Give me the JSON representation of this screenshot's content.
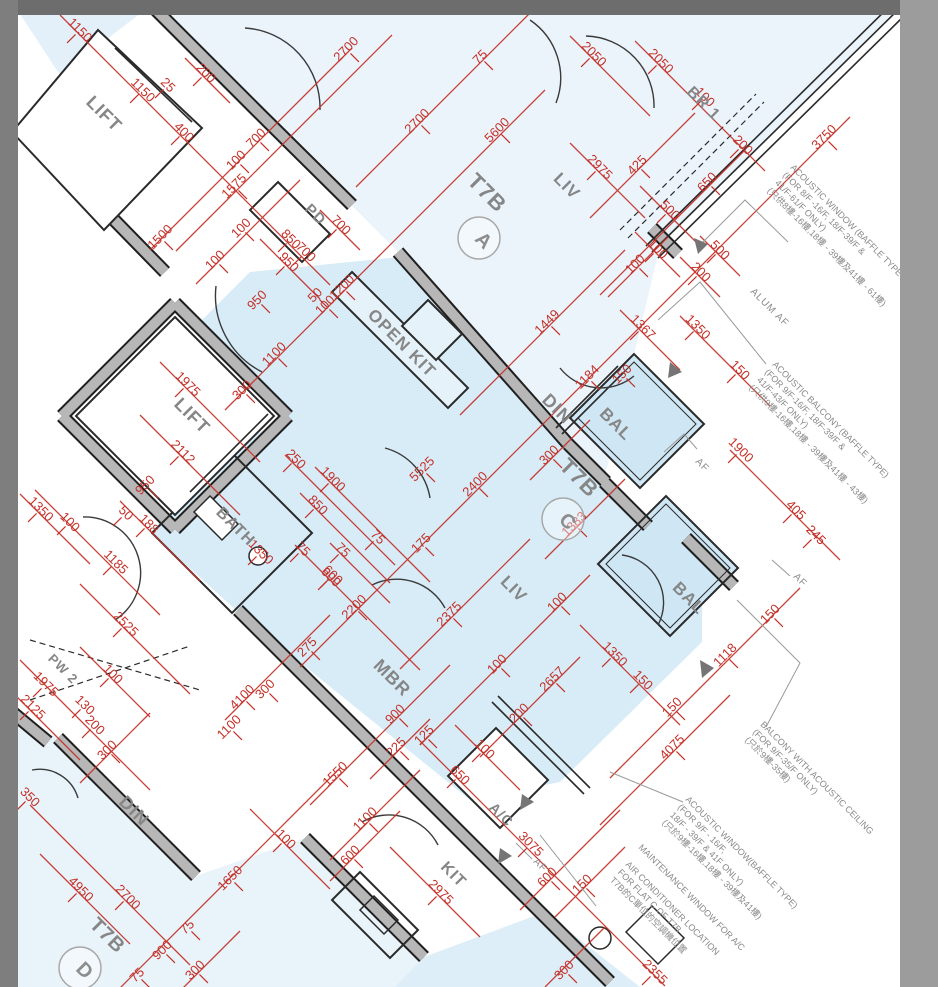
{
  "drawing": {
    "block_name": "T7B",
    "flats_visible": [
      "A",
      "C",
      "D"
    ],
    "colors": {
      "dimension_red": "#c43028",
      "wall_gray": "#b7b7b7",
      "wall_edge": "#1f1f1f",
      "floor_blue": "#d7ecf7",
      "floor_pale": "#ebf4fb",
      "label_gray": "#868686",
      "frame_top": "#6d6d6d",
      "frame_left": "#7e7e7e",
      "frame_right": "#9c9c9c"
    }
  },
  "room_labels": [
    {
      "t": "LIFT",
      "x": 100,
      "y": 118,
      "s": 18
    },
    {
      "t": "PD",
      "x": 312,
      "y": 218,
      "s": 15
    },
    {
      "t": "T7B",
      "x": 482,
      "y": 198,
      "s": 22
    },
    {
      "t": "LIV",
      "x": 563,
      "y": 190,
      "s": 17
    },
    {
      "t": "BR 1",
      "x": 700,
      "y": 107,
      "s": 16
    },
    {
      "t": "OPEN KIT",
      "x": 398,
      "y": 347,
      "s": 17
    },
    {
      "t": "DIN",
      "x": 553,
      "y": 413,
      "s": 18
    },
    {
      "t": "BAL",
      "x": 612,
      "y": 428,
      "s": 17
    },
    {
      "t": "LIFT",
      "x": 188,
      "y": 420,
      "s": 18
    },
    {
      "t": "BATH",
      "x": 232,
      "y": 530,
      "s": 16
    },
    {
      "t": "T7B",
      "x": 574,
      "y": 483,
      "s": 22
    },
    {
      "t": "LIV",
      "x": 510,
      "y": 593,
      "s": 17
    },
    {
      "t": "BAL",
      "x": 685,
      "y": 602,
      "s": 17
    },
    {
      "t": "MBR",
      "x": 388,
      "y": 682,
      "s": 18
    },
    {
      "t": "PW 2",
      "x": 60,
      "y": 672,
      "s": 13
    },
    {
      "t": "DIN",
      "x": 130,
      "y": 815,
      "s": 18
    },
    {
      "t": "A/C",
      "x": 498,
      "y": 818,
      "s": 14
    },
    {
      "t": "KIT",
      "x": 450,
      "y": 878,
      "s": 16
    },
    {
      "t": "T7B",
      "x": 103,
      "y": 940,
      "s": 20
    }
  ],
  "flat_badges": [
    {
      "t": "A",
      "x": 479,
      "y": 238
    },
    {
      "t": "C",
      "x": 563,
      "y": 519
    },
    {
      "t": "D",
      "x": 80,
      "y": 968
    }
  ],
  "annotations": [
    {
      "t": "ALUM AF",
      "x": 750,
      "y": 292
    },
    {
      "t": "AF",
      "x": 695,
      "y": 462
    },
    {
      "t": "AF",
      "x": 793,
      "y": 577
    },
    {
      "t": "AF",
      "x": 533,
      "y": 862
    }
  ],
  "notes": [
    {
      "x": 790,
      "y": 168,
      "lines": [
        "ACOUSTIC WINDOW (BAFFLE TYPE",
        "(FOR 8/F -16/F, 18/F-39/F &",
        "41/F-61/F ONLY)",
        "(只供8樓-16樓,18樓 - 39樓及41樓 - 61樓)"
      ]
    },
    {
      "x": 772,
      "y": 365,
      "lines": [
        "ACOUSTIC BALCONY (BAFFLE TYPE)",
        "(FOR 9/F-16/F, 18/F-39/F &",
        "41/F-43/F ONLY)",
        "(只供9樓-16樓,18樓 - 39樓及41樓 - 43樓)"
      ]
    },
    {
      "x": 760,
      "y": 725,
      "lines": [
        "BALCONY WITH ACOUSTIC CEILING",
        "(FOR 9/F-35/F ONLY)",
        "(只於9樓-35樓)"
      ]
    },
    {
      "x": 685,
      "y": 800,
      "lines": [
        "ACOUSTIC WINDOW(BAFFLE TYPE)",
        "(FOR 9/F - 16/F,",
        "18/F - 39/F & 41F ONLY)",
        "(只於9樓-16樓,18樓 - 39樓及41樓)"
      ]
    },
    {
      "x": 638,
      "y": 848,
      "lines": [
        "MAINTENANCE WINDOW FOR A/C"
      ]
    },
    {
      "x": 625,
      "y": 865,
      "lines": [
        "AIR CONDITIONER LOCATION",
        "FOR FLAT C OF T7B",
        "T7B的C單位的空調機位置"
      ]
    }
  ],
  "dimensions": [
    {
      "t": "1150",
      "x": 77,
      "y": 33,
      "r": 45
    },
    {
      "t": "1150",
      "x": 140,
      "y": 93,
      "r": 45
    },
    {
      "t": "25",
      "x": 165,
      "y": 88,
      "r": 45
    },
    {
      "t": "200",
      "x": 203,
      "y": 76,
      "r": 45
    },
    {
      "t": "400",
      "x": 181,
      "y": 135,
      "r": 45
    },
    {
      "t": "100",
      "x": 239,
      "y": 163,
      "r": -45
    },
    {
      "t": "700",
      "x": 259,
      "y": 141,
      "r": -45
    },
    {
      "t": "1575",
      "x": 237,
      "y": 189,
      "r": -45
    },
    {
      "t": "100",
      "x": 244,
      "y": 231,
      "r": -45
    },
    {
      "t": "1500",
      "x": 163,
      "y": 240,
      "r": -45
    },
    {
      "t": "2700",
      "x": 349,
      "y": 52,
      "r": -45
    },
    {
      "t": "2700",
      "x": 420,
      "y": 124,
      "r": -45
    },
    {
      "t": "75",
      "x": 483,
      "y": 60,
      "r": -45
    },
    {
      "t": "5600",
      "x": 500,
      "y": 133,
      "r": -45
    },
    {
      "t": "2050",
      "x": 591,
      "y": 57,
      "r": 45
    },
    {
      "t": "2050",
      "x": 658,
      "y": 64,
      "r": 45
    },
    {
      "t": "100",
      "x": 702,
      "y": 100,
      "r": 45
    },
    {
      "t": "200",
      "x": 740,
      "y": 148,
      "r": 45
    },
    {
      "t": "3750",
      "x": 827,
      "y": 140,
      "r": -45
    },
    {
      "t": "425",
      "x": 640,
      "y": 168,
      "r": -45
    },
    {
      "t": "650",
      "x": 710,
      "y": 185,
      "r": -45
    },
    {
      "t": "2975",
      "x": 597,
      "y": 170,
      "r": 45
    },
    {
      "t": "500",
      "x": 667,
      "y": 213,
      "r": 45
    },
    {
      "t": "100",
      "x": 655,
      "y": 252,
      "r": 45
    },
    {
      "t": "100",
      "x": 638,
      "y": 267,
      "r": -45
    },
    {
      "t": "500",
      "x": 717,
      "y": 253,
      "r": 45
    },
    {
      "t": "200",
      "x": 698,
      "y": 275,
      "r": 45
    },
    {
      "t": "850",
      "x": 288,
      "y": 242,
      "r": 45
    },
    {
      "t": "950",
      "x": 286,
      "y": 265,
      "r": 45
    },
    {
      "t": "700",
      "x": 338,
      "y": 228,
      "r": 45
    },
    {
      "t": "700",
      "x": 303,
      "y": 255,
      "r": 45
    },
    {
      "t": "100",
      "x": 218,
      "y": 263,
      "r": -45
    },
    {
      "t": "950",
      "x": 260,
      "y": 303,
      "r": -45
    },
    {
      "t": "50",
      "x": 318,
      "y": 298,
      "r": -45
    },
    {
      "t": "100",
      "x": 328,
      "y": 308,
      "r": -45
    },
    {
      "t": "1200",
      "x": 345,
      "y": 290,
      "r": -45
    },
    {
      "t": "1100",
      "x": 277,
      "y": 357,
      "r": -45
    },
    {
      "t": "300",
      "x": 245,
      "y": 393,
      "r": -45
    },
    {
      "t": "1975",
      "x": 185,
      "y": 387,
      "r": 45
    },
    {
      "t": "2112",
      "x": 180,
      "y": 455,
      "r": 45
    },
    {
      "t": "950",
      "x": 148,
      "y": 488,
      "r": -45
    },
    {
      "t": "50",
      "x": 123,
      "y": 516,
      "r": 45
    },
    {
      "t": "188",
      "x": 146,
      "y": 527,
      "r": 45
    },
    {
      "t": "100",
      "x": 67,
      "y": 525,
      "r": 45
    },
    {
      "t": "1350",
      "x": 38,
      "y": 512,
      "r": 45
    },
    {
      "t": "1185",
      "x": 113,
      "y": 565,
      "r": 45
    },
    {
      "t": "250",
      "x": 293,
      "y": 462,
      "r": 45
    },
    {
      "t": "1900",
      "x": 330,
      "y": 482,
      "r": 45
    },
    {
      "t": "850",
      "x": 315,
      "y": 508,
      "r": 45
    },
    {
      "t": "1350",
      "x": 258,
      "y": 555,
      "r": 45
    },
    {
      "t": "75",
      "x": 300,
      "y": 552,
      "r": 45
    },
    {
      "t": "75",
      "x": 340,
      "y": 553,
      "r": 45
    },
    {
      "t": "600",
      "x": 328,
      "y": 580,
      "r": 45
    },
    {
      "t": "75",
      "x": 375,
      "y": 540,
      "r": 45
    },
    {
      "t": "175",
      "x": 424,
      "y": 546,
      "r": -45
    },
    {
      "t": "5525",
      "x": 425,
      "y": 472,
      "r": -45
    },
    {
      "t": "2400",
      "x": 478,
      "y": 487,
      "r": -45
    },
    {
      "t": "300",
      "x": 552,
      "y": 458,
      "r": -45
    },
    {
      "t": "1383",
      "x": 577,
      "y": 527,
      "r": -45
    },
    {
      "t": "1449",
      "x": 550,
      "y": 325,
      "r": -45
    },
    {
      "t": "1184",
      "x": 590,
      "y": 380,
      "r": -45
    },
    {
      "t": "1367",
      "x": 640,
      "y": 330,
      "r": 45
    },
    {
      "t": "1350",
      "x": 695,
      "y": 330,
      "r": 45
    },
    {
      "t": "150",
      "x": 737,
      "y": 373,
      "r": 45
    },
    {
      "t": "150",
      "x": 625,
      "y": 377,
      "r": -45
    },
    {
      "t": "1900",
      "x": 738,
      "y": 453,
      "r": 45
    },
    {
      "t": "405",
      "x": 793,
      "y": 513,
      "r": 45
    },
    {
      "t": "245",
      "x": 813,
      "y": 538,
      "r": 45
    },
    {
      "t": "600",
      "x": 330,
      "y": 578,
      "r": 45
    },
    {
      "t": "2200",
      "x": 357,
      "y": 610,
      "r": -45
    },
    {
      "t": "2375",
      "x": 452,
      "y": 617,
      "r": -45
    },
    {
      "t": "275",
      "x": 310,
      "y": 650,
      "r": -45
    },
    {
      "t": "100",
      "x": 560,
      "y": 605,
      "r": -45
    },
    {
      "t": "2657",
      "x": 555,
      "y": 682,
      "r": -45
    },
    {
      "t": "1350",
      "x": 612,
      "y": 657,
      "r": 45
    },
    {
      "t": "150",
      "x": 640,
      "y": 683,
      "r": 45
    },
    {
      "t": "150",
      "x": 675,
      "y": 710,
      "r": -45
    },
    {
      "t": "1118",
      "x": 728,
      "y": 658,
      "r": -45
    },
    {
      "t": "150",
      "x": 773,
      "y": 617,
      "r": -45
    },
    {
      "t": "100",
      "x": 500,
      "y": 667,
      "r": -45
    },
    {
      "t": "200",
      "x": 522,
      "y": 716,
      "r": -45
    },
    {
      "t": "4075",
      "x": 675,
      "y": 750,
      "r": -45
    },
    {
      "t": "900",
      "x": 398,
      "y": 717,
      "r": -45
    },
    {
      "t": "225",
      "x": 399,
      "y": 750,
      "r": -45
    },
    {
      "t": "125",
      "x": 427,
      "y": 738,
      "r": -45
    },
    {
      "t": "1550",
      "x": 338,
      "y": 777,
      "r": -45
    },
    {
      "t": "650",
      "x": 457,
      "y": 778,
      "r": 45
    },
    {
      "t": "100",
      "x": 482,
      "y": 752,
      "r": 45
    },
    {
      "t": "4100",
      "x": 245,
      "y": 700,
      "r": -45
    },
    {
      "t": "300",
      "x": 268,
      "y": 692,
      "r": -45
    },
    {
      "t": "1100",
      "x": 232,
      "y": 730,
      "r": -45
    },
    {
      "t": "300",
      "x": 110,
      "y": 753,
      "r": -45
    },
    {
      "t": "2525",
      "x": 123,
      "y": 627,
      "r": 45
    },
    {
      "t": "1975",
      "x": 43,
      "y": 687,
      "r": 45
    },
    {
      "t": "2125",
      "x": 30,
      "y": 710,
      "r": 45
    },
    {
      "t": "100",
      "x": 110,
      "y": 677,
      "r": 45
    },
    {
      "t": "130",
      "x": 82,
      "y": 708,
      "r": 45
    },
    {
      "t": "200",
      "x": 92,
      "y": 728,
      "r": 45
    },
    {
      "t": "350",
      "x": 27,
      "y": 800,
      "r": 45
    },
    {
      "t": "1100",
      "x": 368,
      "y": 822,
      "r": -45
    },
    {
      "t": "100",
      "x": 283,
      "y": 842,
      "r": 45
    },
    {
      "t": "600",
      "x": 353,
      "y": 858,
      "r": -45
    },
    {
      "t": "1650",
      "x": 233,
      "y": 881,
      "r": -45
    },
    {
      "t": "4950",
      "x": 78,
      "y": 892,
      "r": 45
    },
    {
      "t": "2700",
      "x": 125,
      "y": 900,
      "r": 45
    },
    {
      "t": "75",
      "x": 190,
      "y": 930,
      "r": -45
    },
    {
      "t": "900",
      "x": 165,
      "y": 953,
      "r": -45
    },
    {
      "t": "300",
      "x": 198,
      "y": 973,
      "r": -45
    },
    {
      "t": "75",
      "x": 140,
      "y": 978,
      "r": -45
    },
    {
      "t": "3075",
      "x": 528,
      "y": 847,
      "r": 45
    },
    {
      "t": "600",
      "x": 550,
      "y": 880,
      "r": -45
    },
    {
      "t": "150",
      "x": 585,
      "y": 887,
      "r": -45
    },
    {
      "t": "300",
      "x": 567,
      "y": 973,
      "r": -45
    },
    {
      "t": "2975",
      "x": 438,
      "y": 895,
      "r": 45
    },
    {
      "t": "2355",
      "x": 652,
      "y": 975,
      "r": 45
    }
  ]
}
